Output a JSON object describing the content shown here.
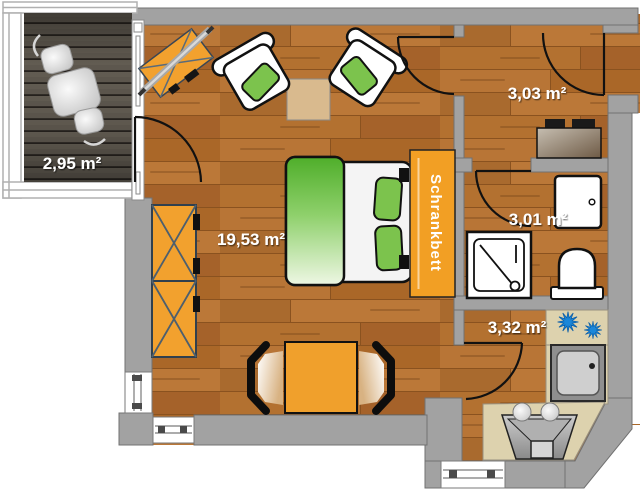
{
  "floorplan": {
    "rooms": {
      "balcony": {
        "area_label": "2,95 m²"
      },
      "living_room": {
        "area_label": "19,53 m²"
      },
      "hallway": {
        "area_label": "3,03 m²"
      },
      "bathroom": {
        "area_label": "3,01 m²"
      },
      "kitchen": {
        "area_label": "3,32 m²"
      }
    },
    "labels": {
      "wall_bed": "Schrankbett"
    },
    "icons": [
      "burner-icon",
      "shower-icon",
      "toilet-icon",
      "sink-icon"
    ],
    "colors": {
      "wall": "#a2a2a2",
      "wood_floor": "#b06d2c",
      "deck": "#5d574e",
      "furniture_orange": "#f2a12e",
      "textile_green": "#7cc34d",
      "counter_beige": "#ddd2ae",
      "burner_blue": "#1b87d9",
      "label_text": "#ffffff"
    }
  }
}
